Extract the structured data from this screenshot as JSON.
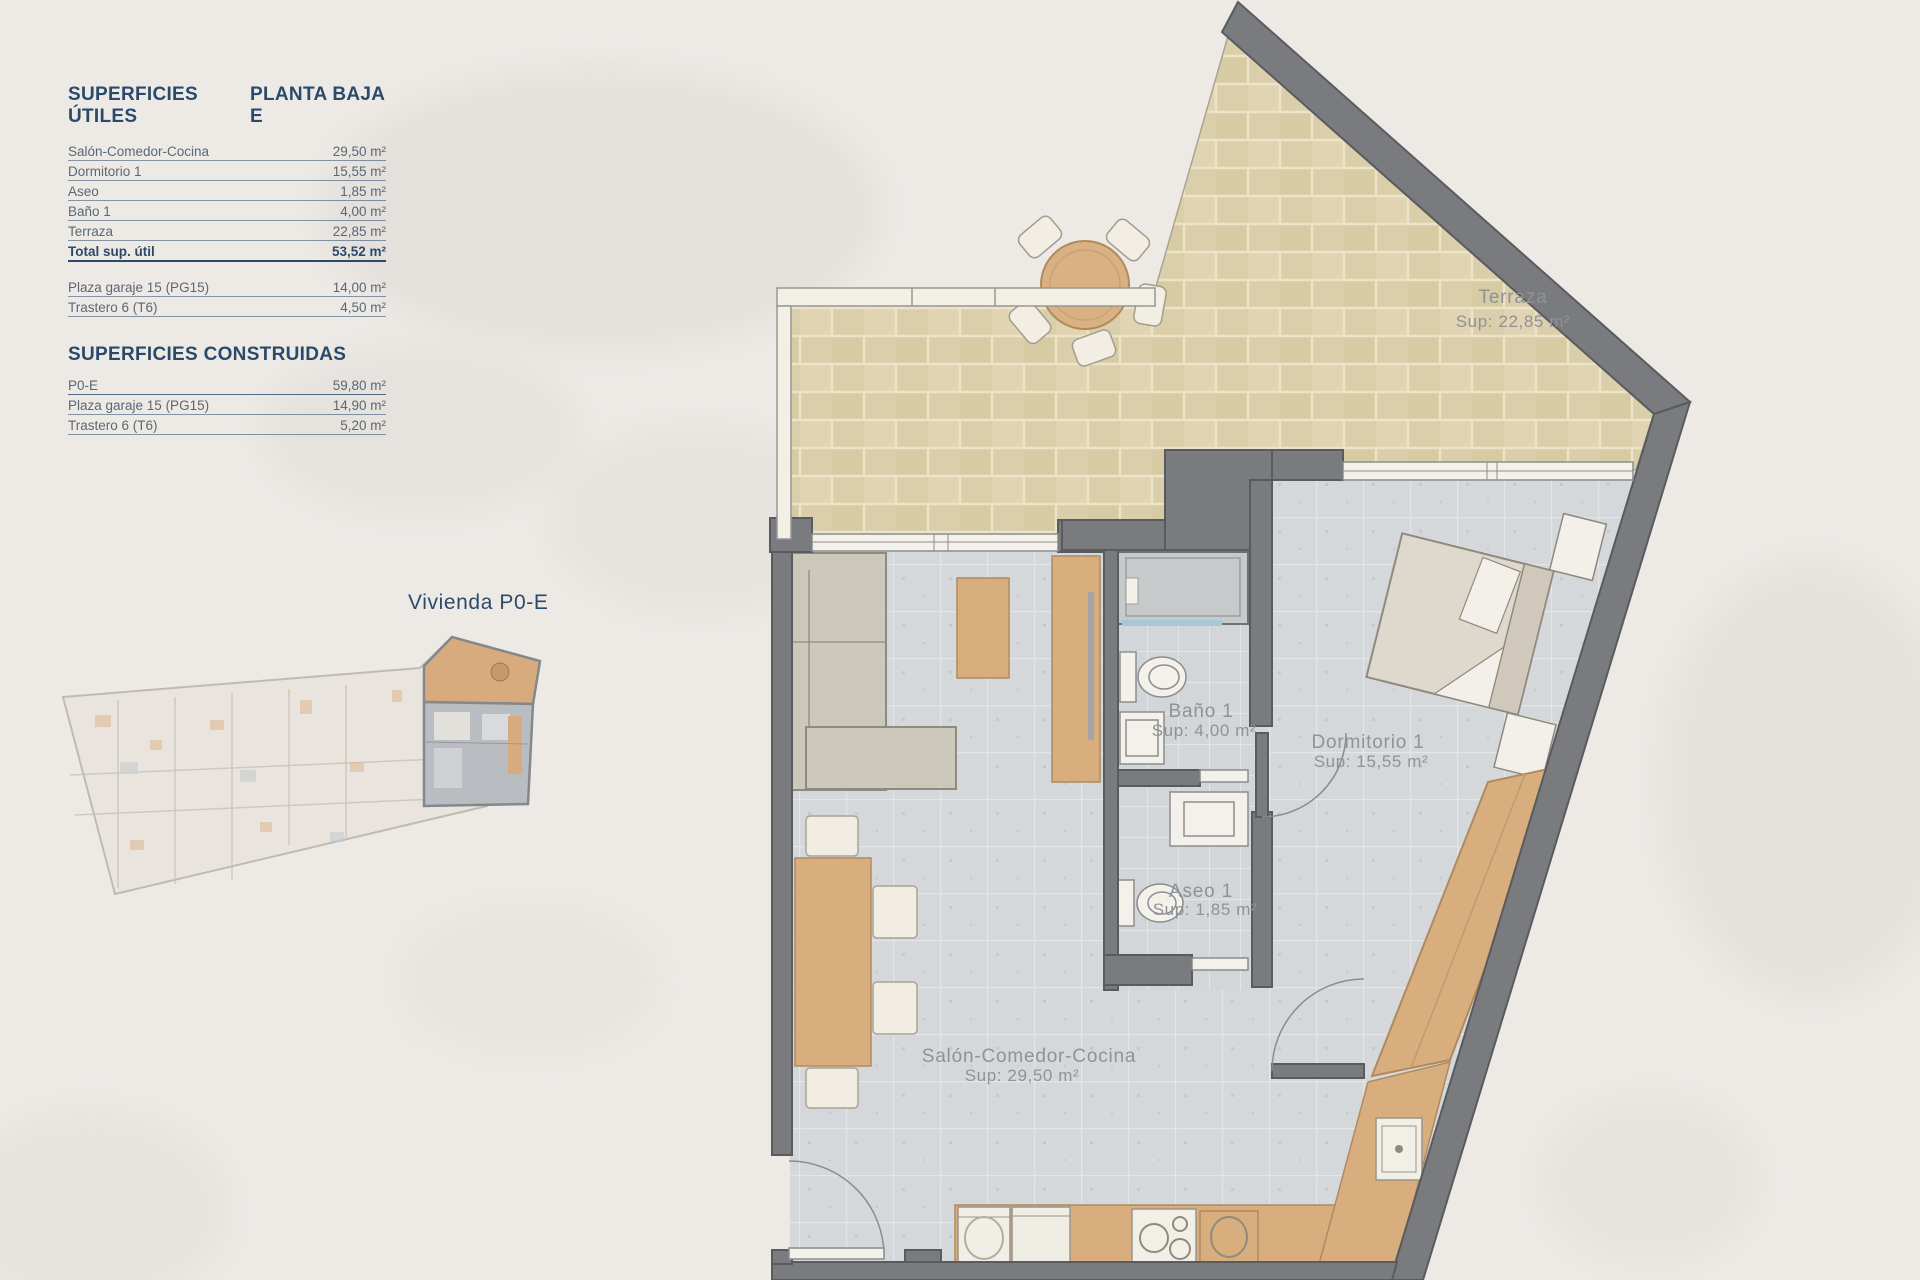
{
  "colors": {
    "background": "#edeae6",
    "heading_blue": "#2b4a6b",
    "table_text": "#5a6774",
    "wall_gray": "#797b7e",
    "terrace_tile": "#dbcfab",
    "floor_tile": "#d5d8db",
    "wood": "#d8ae7e",
    "room_label_gray": "#8f9296",
    "mini_highlight_tan": "#d8ab7f",
    "mini_highlight_gray": "#b9bcc0"
  },
  "surfaces_utiles": {
    "title": "SUPERFICIES ÚTILES",
    "plan_name": "PLANTA BAJA E",
    "rows": [
      {
        "label": "Salón-Comedor-Cocina",
        "value": "29,50 m²"
      },
      {
        "label": "Dormitorio 1",
        "value": "15,55 m²"
      },
      {
        "label": "Aseo",
        "value": "1,85 m²"
      },
      {
        "label": "Baño 1",
        "value": "4,00 m²"
      },
      {
        "label": "Terraza",
        "value": "22,85 m²"
      }
    ],
    "total": {
      "label": "Total sup. útil",
      "value": "53,52 m²"
    },
    "annex_rows": [
      {
        "label": "Plaza garaje 15 (PG15)",
        "value": "14,00 m²"
      },
      {
        "label": "Trastero 6 (T6)",
        "value": "4,50 m²"
      }
    ]
  },
  "surfaces_construidas": {
    "title": "SUPERFICIES CONSTRUIDAS",
    "rows": [
      {
        "label": "P0-E",
        "value": "59,80 m²"
      },
      {
        "label": "Plaza garaje 15 (PG15)",
        "value": "14,90 m²"
      },
      {
        "label": "Trastero 6 (T6)",
        "value": "5,20 m²"
      }
    ]
  },
  "mini_plan": {
    "label": "Vivienda P0-E"
  },
  "floor_plan": {
    "rooms": [
      {
        "name": "Terraza",
        "area": "Sup: 22,85 m²"
      },
      {
        "name": "Baño 1",
        "area": "Sup: 4,00 m²"
      },
      {
        "name": "Dormitorio 1",
        "area": "Sup: 15,55 m²"
      },
      {
        "name": "Aseo 1",
        "area": "Sup: 1,85 m²"
      },
      {
        "name": "Salón-Comedor-Cocina",
        "area": "Sup: 29,50 m²"
      }
    ]
  }
}
